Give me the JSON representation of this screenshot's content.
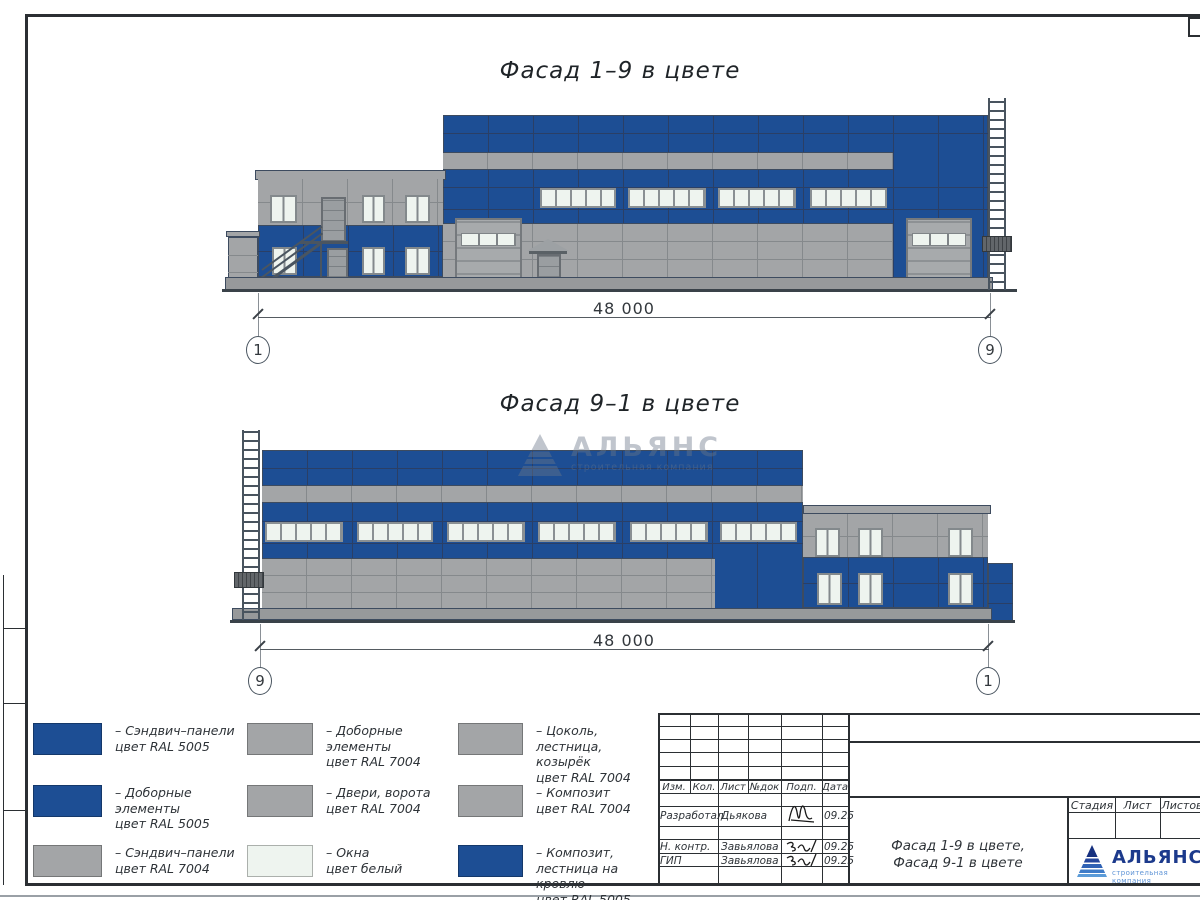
{
  "colors": {
    "panel_blue": "#1d4e94",
    "panel_gray": "#a3a5a7",
    "window_white": "#eef4ef",
    "outline": "#3d4b5f",
    "joint_blue": "#2a3f66",
    "joint_gray": "#85898c",
    "ground": "#3a4249",
    "logo_blue": "#1c3a8c",
    "logo_light_blue": "#5d93d6"
  },
  "facade_top": {
    "title": "Фасад 1–9 в цвете",
    "dimension": "48 000",
    "axis_left": "1",
    "axis_right": "9"
  },
  "facade_bottom": {
    "title": "Фасад 9–1 в цвете",
    "dimension": "48 000",
    "axis_left": "9",
    "axis_right": "1"
  },
  "watermark": {
    "name": "АЛЬЯНС",
    "tagline": "строительная компания"
  },
  "legend": {
    "items": [
      {
        "color": "blue",
        "label": "– Сэндвич–панели\nцвет RAL 5005"
      },
      {
        "color": "blue",
        "label": "– Доборные элементы\nцвет RAL 5005"
      },
      {
        "color": "gray",
        "label": "– Сэндвич–панели\nцвет RAL 7004"
      },
      {
        "color": "gray",
        "label": "– Доборные элементы\nцвет RAL 7004"
      },
      {
        "color": "gray",
        "label": "– Двери, ворота\nцвет RAL 7004"
      },
      {
        "color": "white",
        "label": "– Окна\nцвет белый"
      },
      {
        "color": "gray",
        "label": "– Цоколь, лестница,\nкозырёк\nцвет RAL 7004"
      },
      {
        "color": "gray",
        "label": "– Композит\nцвет RAL 7004"
      },
      {
        "color": "blue",
        "label": "– Композит,\nлестница на кровлю\nцвет RAL 5005"
      }
    ]
  },
  "title_block": {
    "columns": [
      "Изм.",
      "Кол.",
      "Лист",
      "№док",
      "Подп.",
      "Дата"
    ],
    "rows": [
      {
        "role": "Разработал",
        "name": "Дьякова",
        "date": "09.25"
      },
      {
        "role": "Н. контр.",
        "name": "Завьялова",
        "date": "09.25"
      },
      {
        "role": "ГИП",
        "name": "Завьялова",
        "date": "09.25"
      }
    ],
    "stage_columns": [
      "Стадия",
      "Лист",
      "Листов"
    ],
    "doc_title_line1": "Фасад 1-9 в цвете,",
    "doc_title_line2": "Фасад 9-1 в цвете",
    "logo_name": "АЛЬЯНС",
    "logo_tagline": "строительная компания"
  }
}
